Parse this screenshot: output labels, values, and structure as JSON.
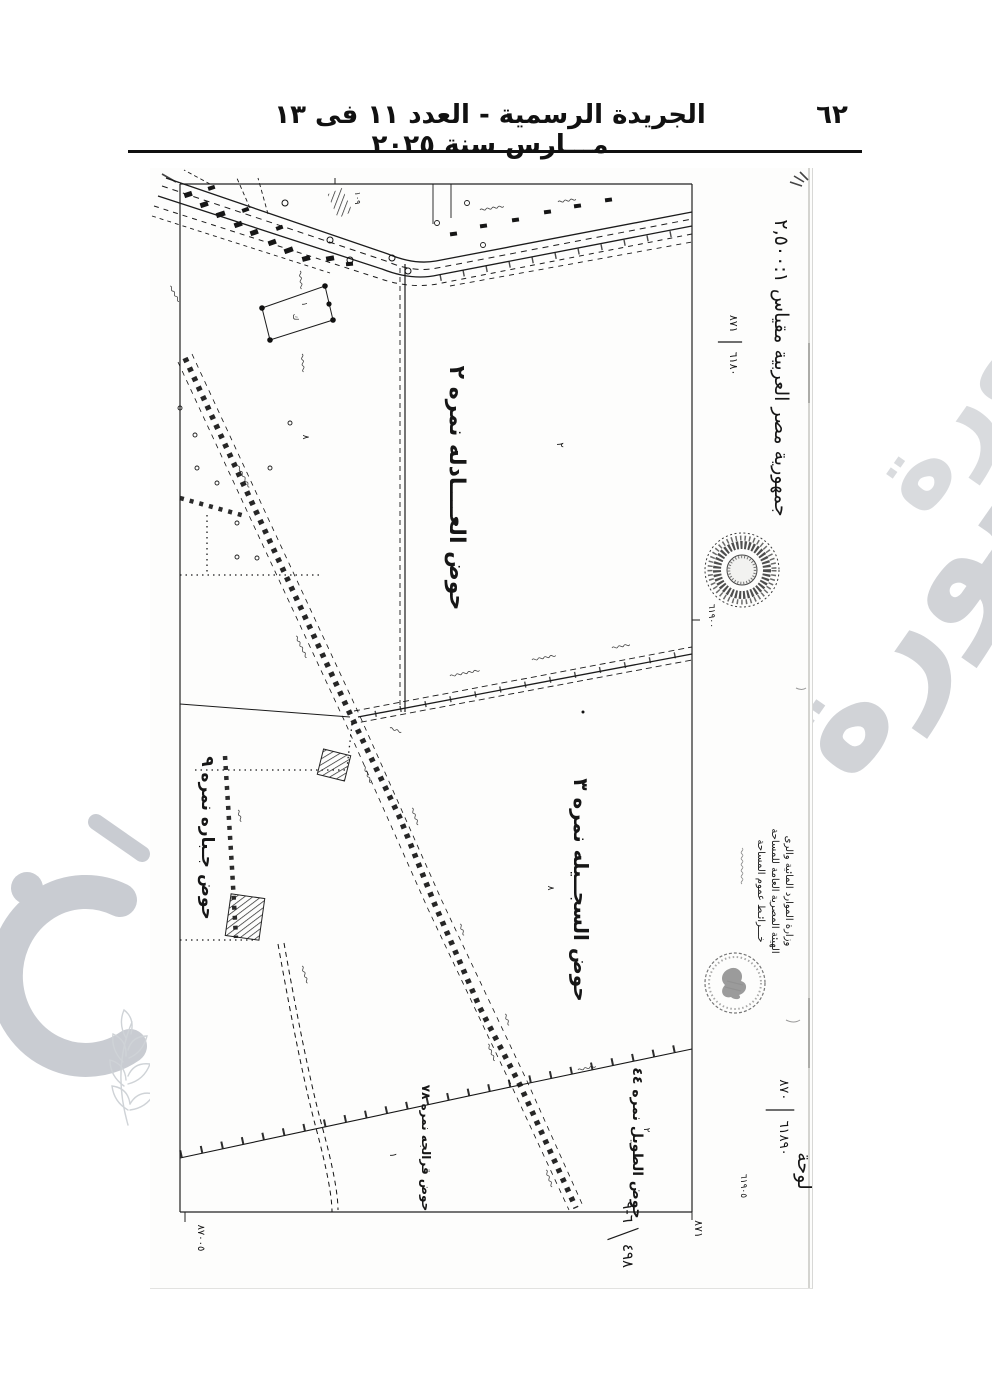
{
  "header": {
    "title": "الجريدة الرسمية - العدد ١١ فى ١٣ مـــارس سنة ٢٠٢٥",
    "page_number": "٦٢"
  },
  "watermark": {
    "word": "صورة"
  },
  "map": {
    "hod_labels": [
      {
        "text": "حوض العــــادله نمره ٢",
        "x": 300,
        "y": 320,
        "size": 22
      },
      {
        "text": "حوض السجــيله نمره ٣",
        "x": 424,
        "y": 722,
        "size": 20
      },
      {
        "text": "حوض جـباره نمره ٩",
        "x": 52,
        "y": 670,
        "size": 17
      },
      {
        "text": "حوض الطويل نمره ٤٤",
        "x": 483,
        "y": 975,
        "size": 14
      },
      {
        "text": "حوض قرالجه نمره ٧٨",
        "x": 272,
        "y": 980,
        "size": 12
      }
    ],
    "parcel_marks": [
      {
        "text": "١٠٩",
        "x": 205,
        "y": 30,
        "size": 8
      },
      {
        "text": "٨",
        "x": 153,
        "y": 269,
        "size": 9
      },
      {
        "text": "٢",
        "x": 407,
        "y": 277,
        "size": 10
      },
      {
        "text": "٨",
        "x": 398,
        "y": 720,
        "size": 9
      },
      {
        "text": "٢",
        "x": 494,
        "y": 962,
        "size": 9
      },
      {
        "text": "١",
        "x": 240,
        "y": 987,
        "size": 10
      },
      {
        "text": "١",
        "x": 152,
        "y": 136,
        "size": 8
      },
      {
        "text": "ك",
        "x": 143,
        "y": 149,
        "size": 8
      }
    ],
    "margin_texts": [
      {
        "text": "جمهورية مصر العربية مقياس ٢,٥٠٠:١",
        "x": 625,
        "y": 200,
        "size": 19,
        "name": "country-scale-label"
      },
      {
        "text": "٦١٩٠٠",
        "x": 559,
        "y": 448,
        "size": 9,
        "name": "grid-number-mid"
      },
      {
        "text": "وزارة الموارد المائية والرى",
        "x": 636,
        "y": 723,
        "size": 10,
        "name": "stamp-line-1"
      },
      {
        "text": "الهيئة المصرية العامة للمساحة",
        "x": 622,
        "y": 723,
        "size": 10,
        "name": "stamp-line-2"
      },
      {
        "text": "خـــرائـط عموم المساحة",
        "x": 608,
        "y": 723,
        "size": 10,
        "name": "stamp-line-3"
      },
      {
        "text": "لوحة",
        "x": 648,
        "y": 1003,
        "size": 19,
        "name": "sheet-word"
      },
      {
        "text": "٦١٩٠٥",
        "x": 591,
        "y": 1018,
        "size": 9,
        "name": "grid-number-bottom"
      },
      {
        "text": "٨٧١",
        "x": 545,
        "y": 1061,
        "size": 11,
        "name": "corner-number-right"
      },
      {
        "text": "٨٧٠٠٥",
        "x": 48,
        "y": 1070,
        "size": 10,
        "name": "corner-number-left"
      }
    ],
    "fractions": [
      {
        "top": "٨٧١",
        "bottom": "٦١٨٠",
        "x": 580,
        "y": 174,
        "size": 11,
        "tilt": 0,
        "name": "sheet-fraction-top"
      },
      {
        "top": "٨٧٠",
        "bottom": "٦١٨٩٠",
        "x": 630,
        "y": 942,
        "size": 13,
        "tilt": 0,
        "name": "sheet-fraction-bottom"
      },
      {
        "top": "٦-٩",
        "bottom": "٤٩٨",
        "x": 473,
        "y": 1066,
        "size": 15,
        "tilt": -20,
        "name": "handwritten-fraction"
      }
    ]
  }
}
